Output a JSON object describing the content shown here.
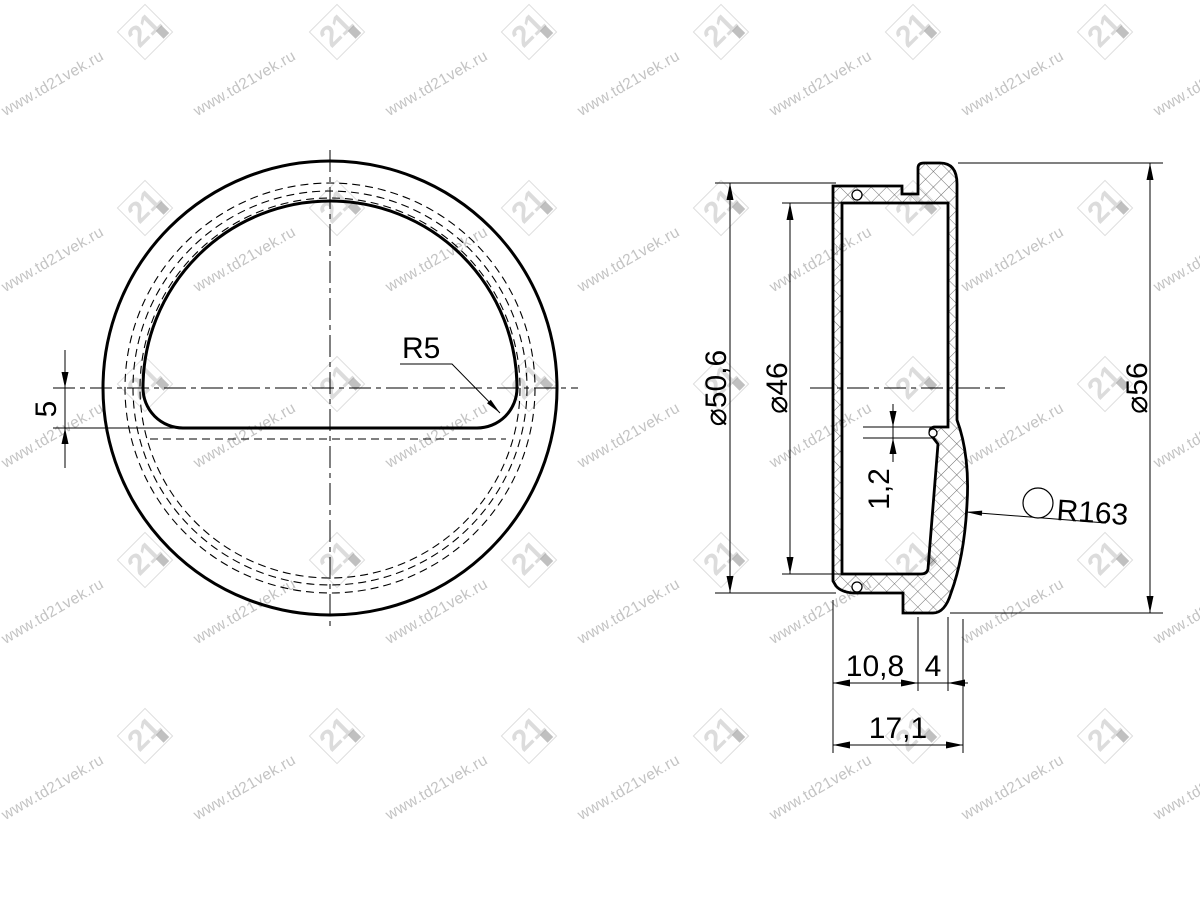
{
  "watermark": {
    "text": "www.td21vek.ru",
    "logo_text": "21",
    "text_color": "#c3c3c3",
    "logo_color": "#dedede"
  },
  "colors": {
    "background": "#ffffff",
    "line": "#000000"
  },
  "front_view": {
    "corner_radius_label": "R5",
    "flat_offset_label": "5"
  },
  "section_view": {
    "dia_body": "⌀50,6",
    "dia_opening": "⌀46",
    "dia_overall": "⌀56",
    "edge_thickness": "1,2",
    "lip_radius_label": "R163",
    "depth_body": "10,8",
    "lip_width": "4",
    "depth_total": "17,1"
  }
}
